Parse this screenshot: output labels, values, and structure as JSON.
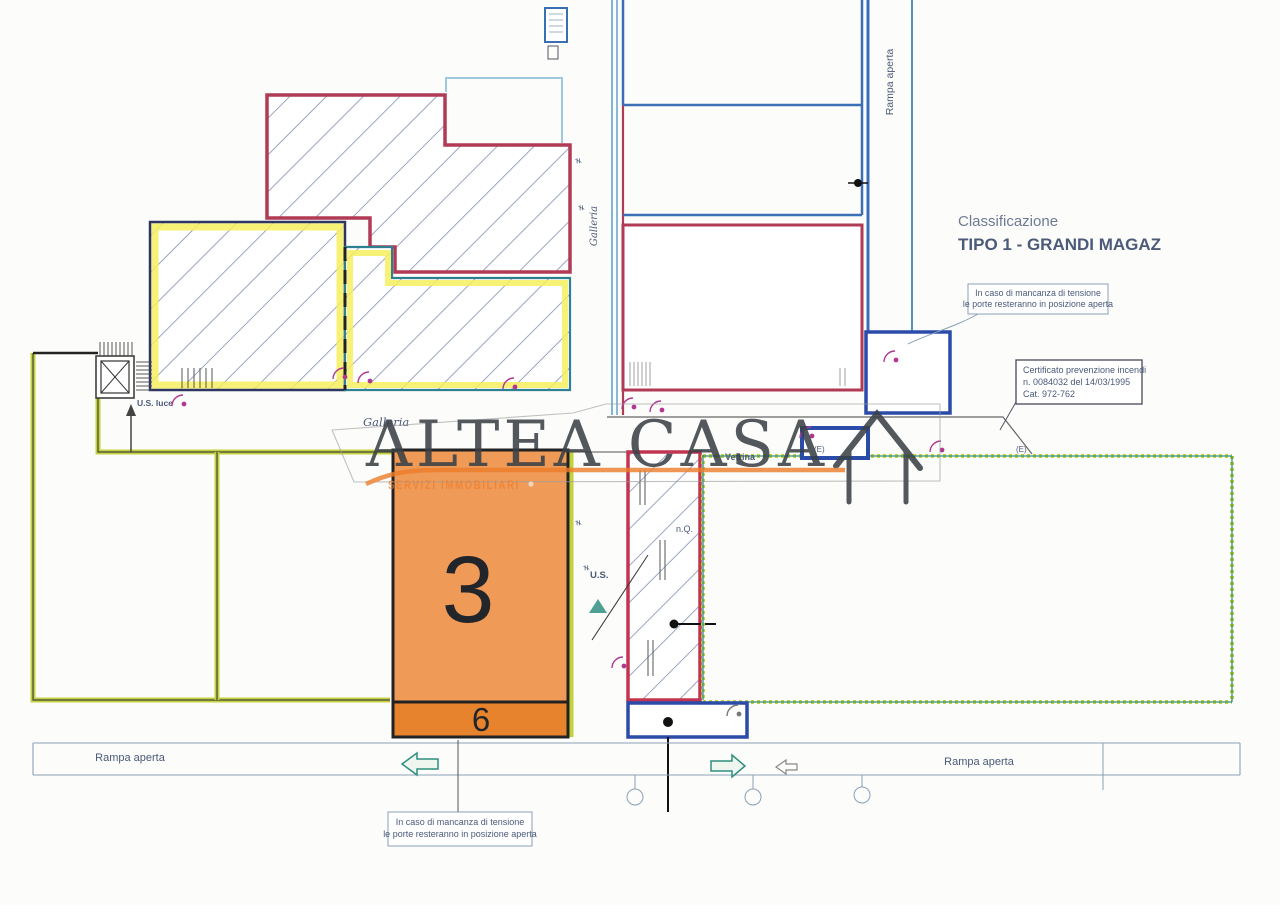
{
  "plan": {
    "unit": {
      "number": "3",
      "lower_number": "6"
    },
    "classification": {
      "title": "Classificazione",
      "type": "TIPO 1 - GRANDI MAGAZ"
    },
    "notes": {
      "door_note_top": {
        "line1": "In caso di mancanza di tensione",
        "line2": "le porte resteranno in posizione aperta"
      },
      "door_note_bottom": {
        "line1": "In caso di mancanza di tensione",
        "line2": "le porte resteranno in posizione aperta"
      },
      "fire_certificate": {
        "line1": "Certificato prevenzione incendi",
        "line2": "n. 0084032 del 14/03/1995",
        "line3": "Cat. 972-762"
      }
    },
    "labels": {
      "ramp_left": "Rampa aperta",
      "ramp_right": "Rampa aperta",
      "ramp_top": "Rampa aperta",
      "gallery_horizontal": "Galleria",
      "gallery_vertical": "Galleria",
      "exit_left": "U.S. luce",
      "exit_center": "U.S.",
      "nq": "n.Q.",
      "shopfront": "Vetrina",
      "emergency_mark": "(E)",
      "dim_mark": "≠"
    }
  },
  "watermark": {
    "brand": "ALTEA CASA",
    "subtitle": "SERVIZI IMMOBILIARI"
  },
  "colors": {
    "paper": "#fcfcfa",
    "orange": "#F09A58",
    "orange-dark": "#E8832D",
    "accent": "#ED7D2A",
    "crimson": "#B13A55",
    "blue": "#3A6FB5",
    "cyan": "#7DB7D4",
    "cyan-dark": "#4F93C0",
    "navy": "#2B4BA8",
    "chartreuse": "#C3D23C",
    "yellow": "#F6EE5D",
    "teal": "#2F8F7F",
    "magenta": "#B03990",
    "ann": "#4A5A78",
    "ink": "#22252A",
    "hatch": "#9AA6C0",
    "wm": "#3A4046",
    "line": "#8AA0B8"
  }
}
